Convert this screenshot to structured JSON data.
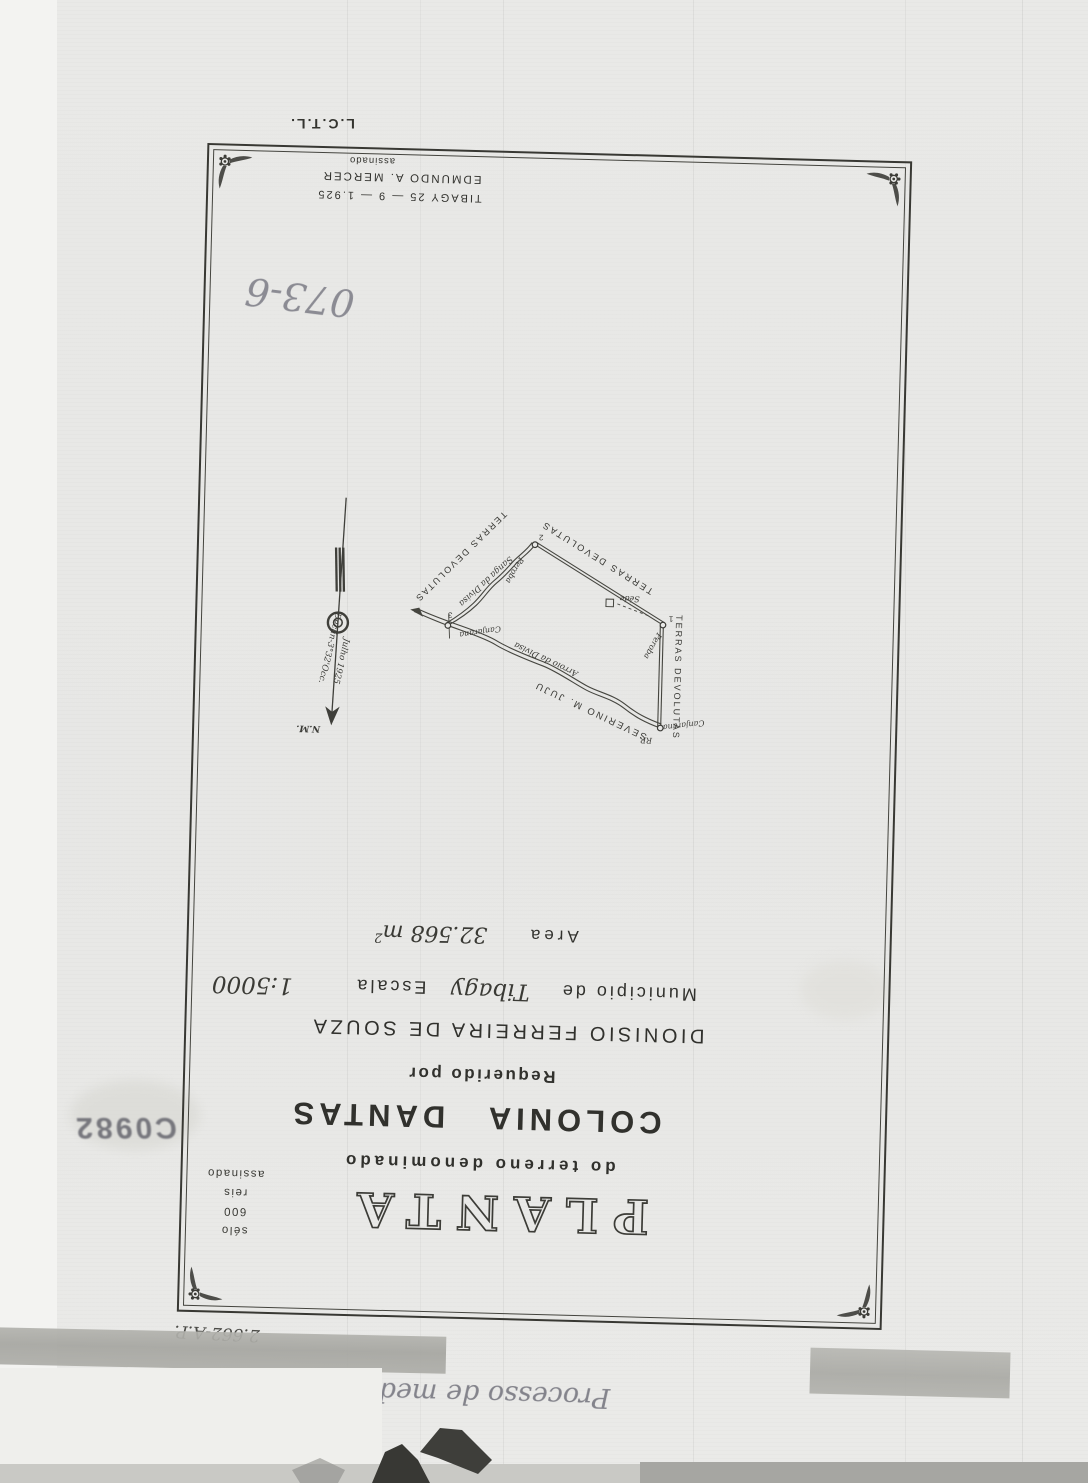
{
  "colors": {
    "paper": "#e8e8e6",
    "ink": "#35352f",
    "pencil": "#8b8b93",
    "stamp_ink": "#5d5d66",
    "tape": "#a9a9a4"
  },
  "scan": {
    "corner_mark": "L.C.T.L.",
    "archive_number": "073-6",
    "stamp_number": "C0982",
    "file_number": "2.662-A.P.",
    "bottom_note_text": "Processo de medição",
    "bottom_note_number": "2662 - AP"
  },
  "document": {
    "title": "PLANTA",
    "subtitle": "do terreno denominado",
    "land_name": "COLONIA  DANTAS",
    "requested_by_label": "Requerido por",
    "requester": "DIONISIO FERREIRA DE SOUZA",
    "municipality_label": "Municipio de",
    "municipality": "Tibagy",
    "scale_label": "Escala",
    "scale": "1:5000",
    "area_label": "Area",
    "area_value": "32.568 m",
    "area_exponent": "2",
    "seal_line1": "sélo",
    "seal_line2": "600",
    "seal_line3": "reis",
    "seal_line4": "assinado",
    "signature_place_date": "TIBAGY 25 — 9 — 1.925",
    "signature_name": "EDMUNDO A. MERCER",
    "signature_note": "assinado"
  },
  "map": {
    "terras_devolutas_1": "TERRAS DEVOLUTAS",
    "terras_devolutas_2": "TERRAS DEVOLUTAS",
    "terras_devolutas_3": "TERRAS DEVOLUTAS",
    "stream_sanga": "Sanga da Divisa",
    "stream_arroio": "Arroio da Divisa",
    "neighbor": "SEVERINO M. JUJU",
    "corner1_number": "1",
    "corner1_tree": "Peroba",
    "corner2_number": "2",
    "corner2_tree": "Peroba",
    "corner3_number": "3",
    "corner3_tree": "Canjarana",
    "corner4_tree": "Canjarana",
    "corner4_mark": "RP.",
    "homestead": "Séde",
    "compass_north": "N.M.",
    "compass_declination": "Declin-3°32'Occ.",
    "compass_date": "Julho 1925"
  }
}
